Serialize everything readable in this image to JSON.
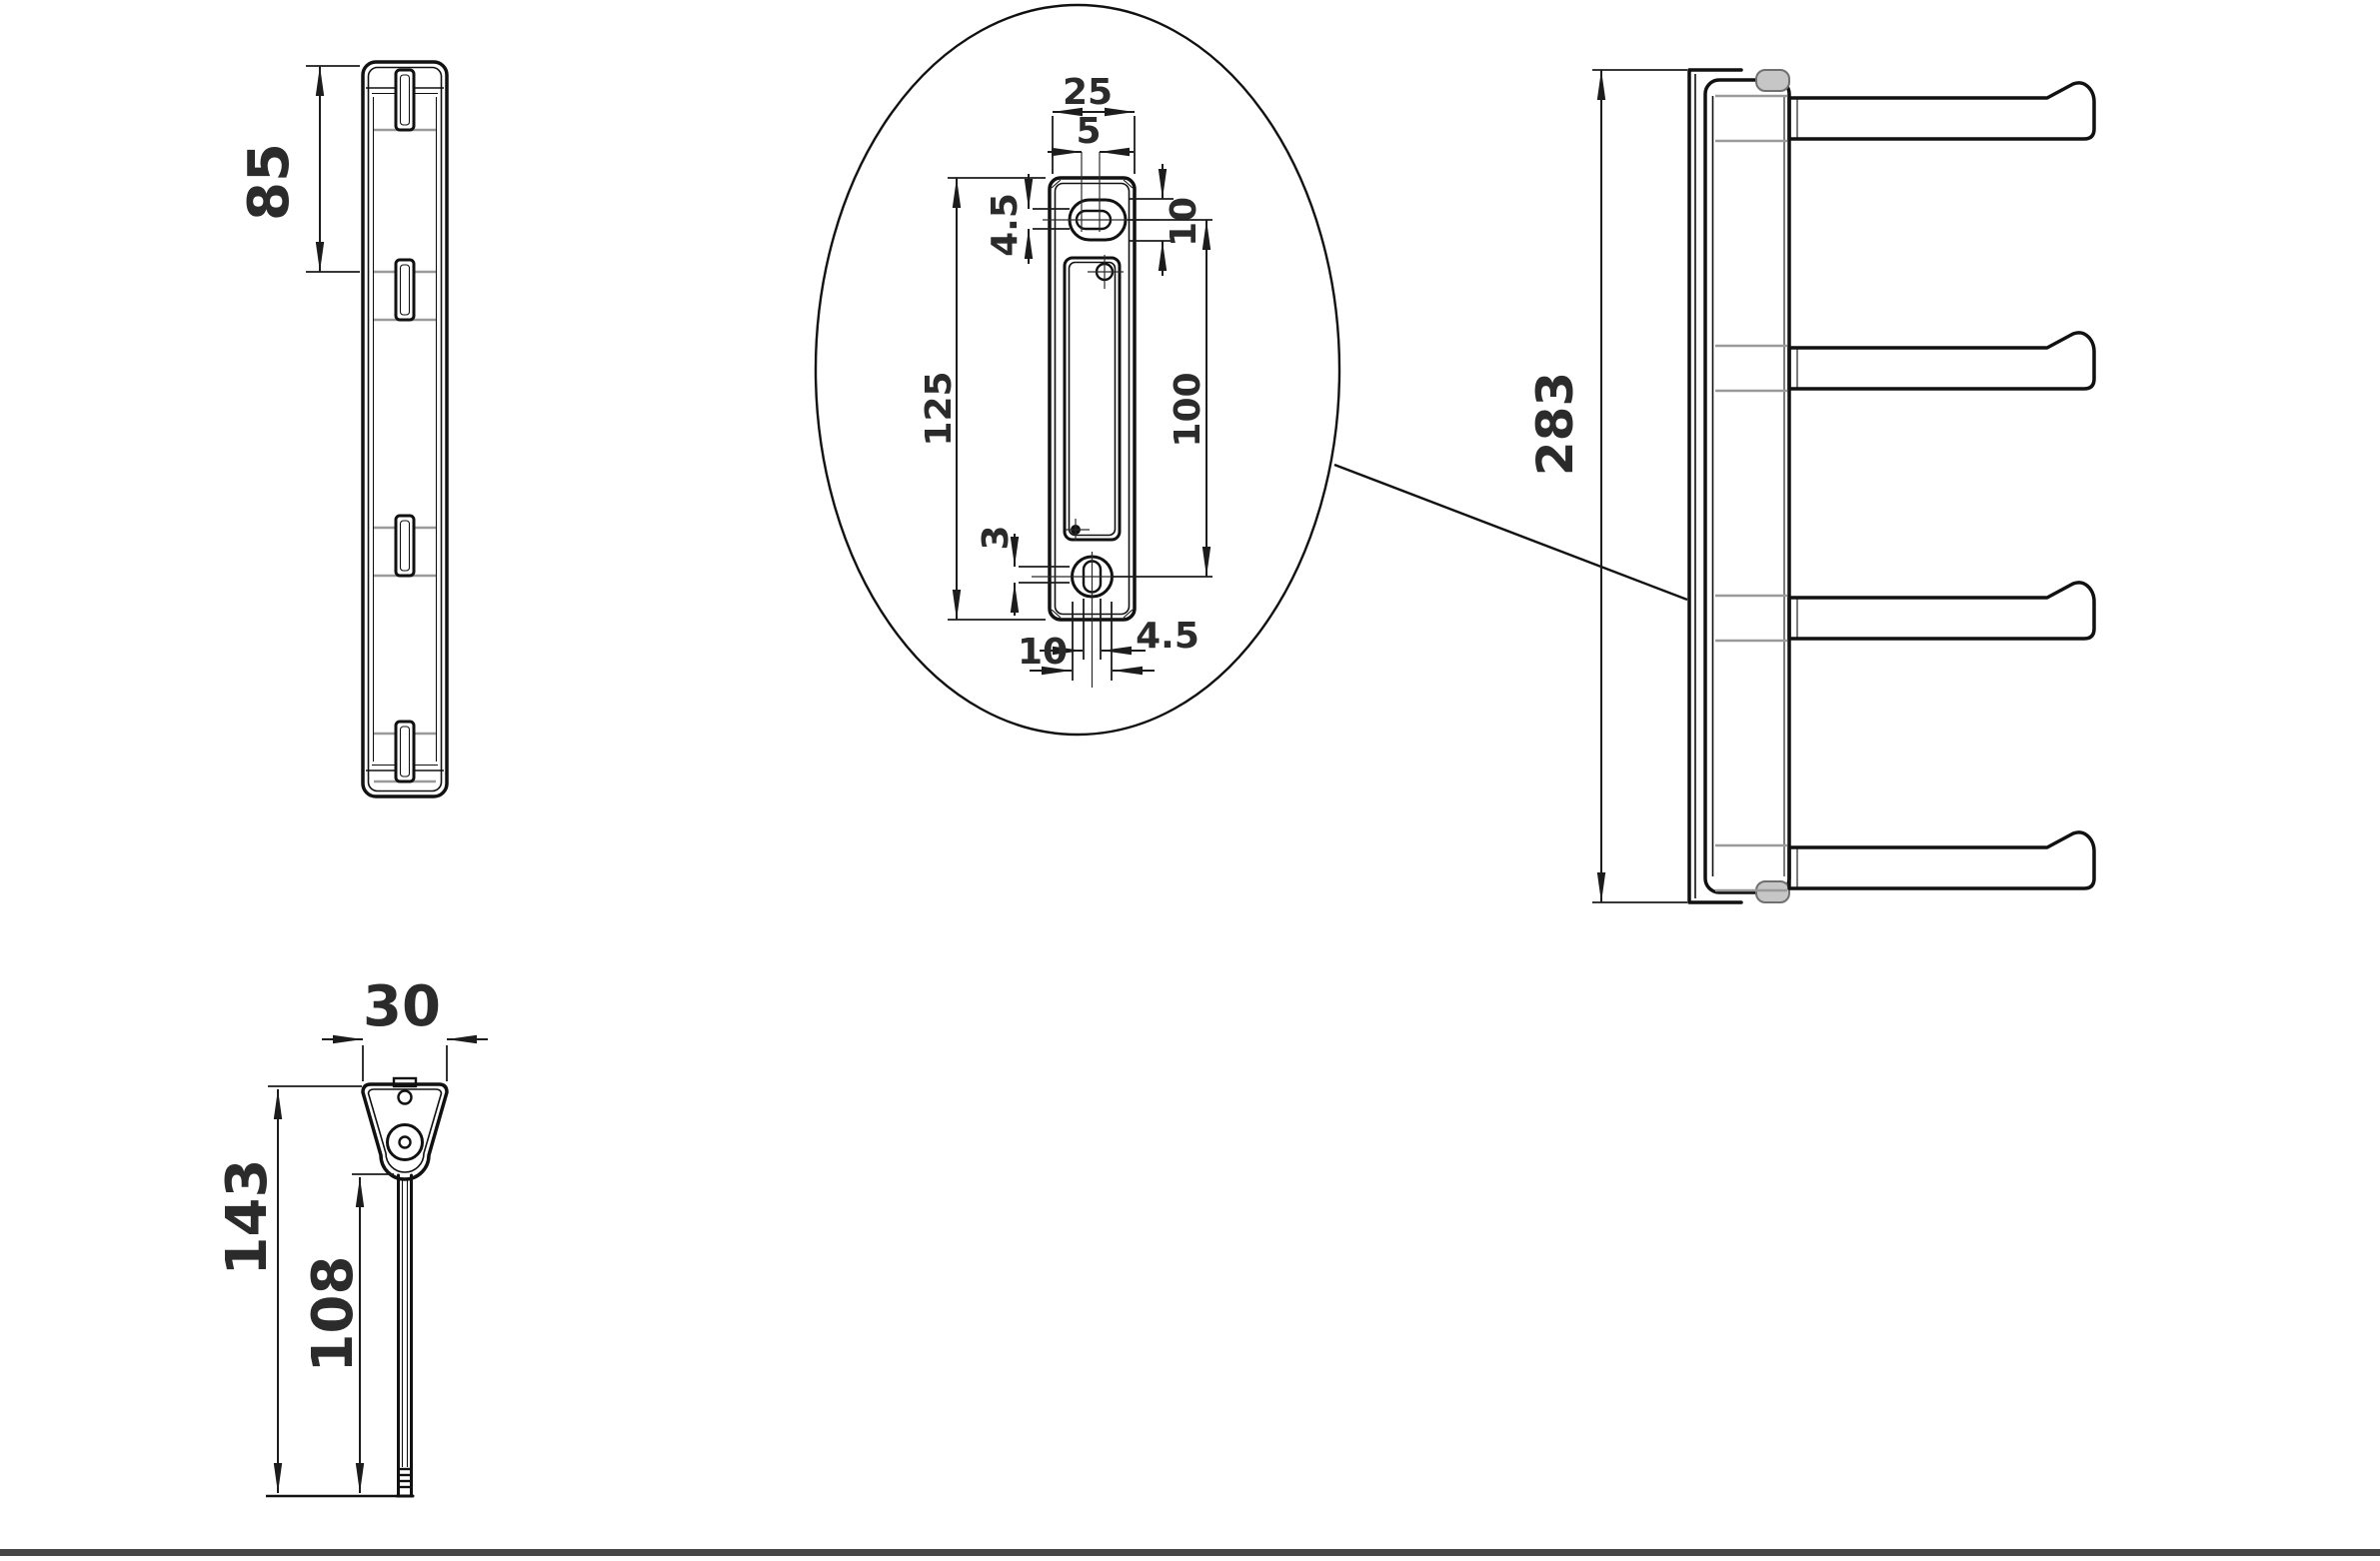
{
  "drawing": {
    "kind": "technical-dimension-drawing",
    "subject": "wall-mounted rack with rail, mounting plate detail and four swing arms",
    "colors": {
      "line": "#111111",
      "dimension_text": "#2b2b2b",
      "shade_line": "#9a9a9a",
      "cap_fill": "#c6c6c6",
      "background": "#ffffff",
      "footer_bar": "#474747"
    },
    "views": {
      "side": {
        "label": "rail-side-view",
        "dim_tab_spacing": "85"
      },
      "detail": {
        "label": "mounting-plate-detail",
        "dim_plate_width": "25",
        "dim_slot_width": "5",
        "dim_slot_height": "4.5",
        "dim_slot_boss_height": "10",
        "dim_plate_height": "125",
        "dim_hole_pitch": "100",
        "dim_bottom_offset": "3",
        "dim_bottom_slot_width": "4.5",
        "dim_bottom_hole_width": "10"
      },
      "front": {
        "label": "rack-front-view",
        "dim_total_height": "283"
      },
      "top": {
        "label": "arm-top-view",
        "dim_bracket_width": "30",
        "dim_total_depth": "143",
        "dim_arm_length": "108"
      }
    }
  }
}
